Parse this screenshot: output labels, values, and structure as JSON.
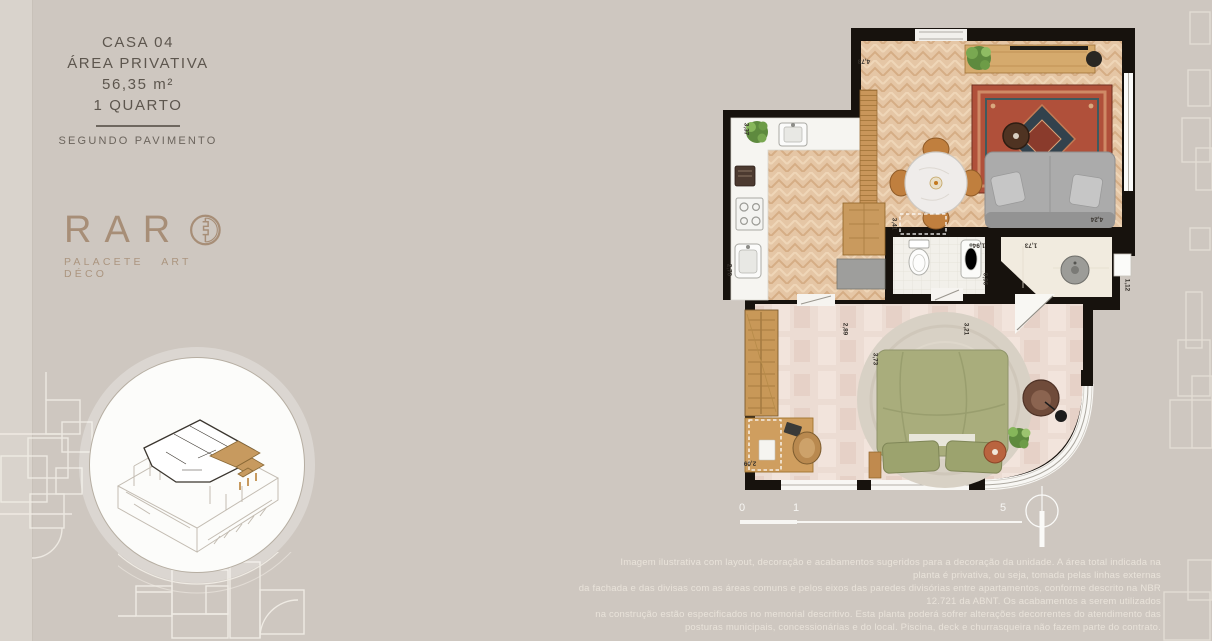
{
  "header": {
    "unit": "CASA 04",
    "area_label": "ÁREA PRIVATIVA",
    "area_value": "56,35 m²",
    "bedrooms": "1 QUARTO",
    "floor": "SEGUNDO PAVIMENTO"
  },
  "logo": {
    "letters": "RAR",
    "tagline": "PALACETE ART DÉCO",
    "color": "#a78e77"
  },
  "plan": {
    "dims": {
      "living_width": "4,78",
      "kitchen_width": "3,37",
      "kitchen_height": "2,70",
      "dining": "3,41",
      "living_height": "4,24",
      "bath_width": "1,94",
      "bath_depth": "0,96",
      "wc_width": "1,73",
      "wc_depth": "1,12",
      "bedroom_east": "3,21",
      "bedroom_west": "2,89",
      "bedroom_width": "3,73",
      "desk_width": "2,09"
    },
    "scale": {
      "zero": "0",
      "one": "1",
      "five": "5"
    },
    "wall_color": "#17120d"
  },
  "disclaimer": {
    "lines": [
      "Imagem ilustrativa com layout, decoração e acabamentos sugeridos para a decoração da unidade. A área total indicada na",
      "planta é privativa, ou seja, tomada pelas linhas externas",
      "da fachada e das divisas com as áreas comuns e pelos eixos das paredes divisórias entre apartamentos, conforme descrito na NBR",
      "12.721 da ABNT. Os acabamentos a serem utilizados",
      "na construção estão especificados no memorial descritivo. Esta planta poderá sofrer alterações decorrentes do atendimento das",
      "posturas municipais, concessionárias e do local. Piscina, deck e churrasqueira não fazem parte do contrato."
    ]
  }
}
